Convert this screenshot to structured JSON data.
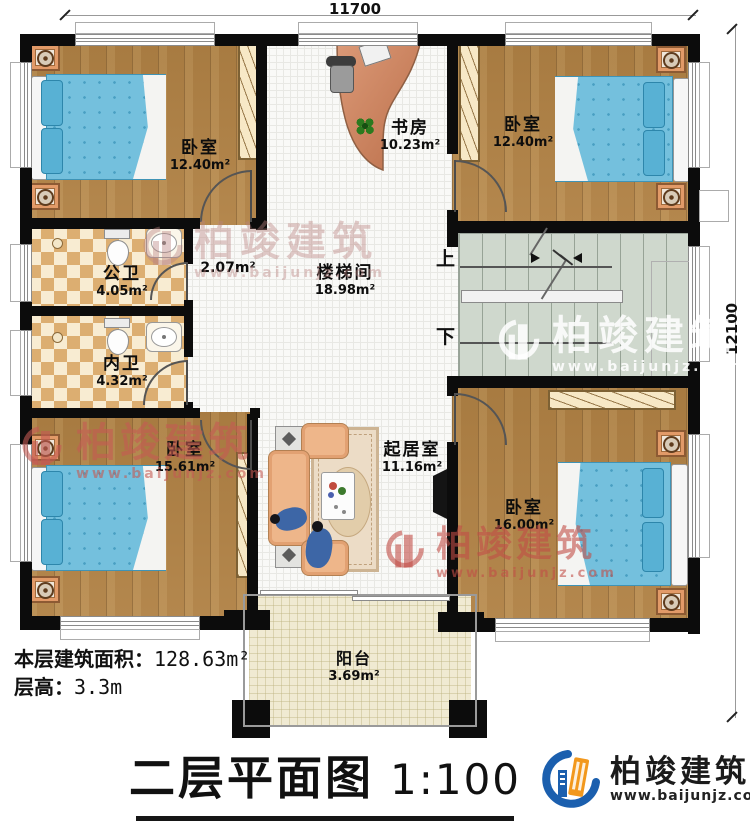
{
  "dimensions": {
    "width": "11700",
    "depth": "12100"
  },
  "rooms": [
    {
      "name": "卧室",
      "area": "12.40m²"
    },
    {
      "name": "书房",
      "area": "10.23m²"
    },
    {
      "name": "卧室",
      "area": "12.40m²"
    },
    {
      "name": "公卫",
      "area": "4.05m²"
    },
    {
      "name": "",
      "area": "2.07m²"
    },
    {
      "name": "楼梯间",
      "area": "18.98m²"
    },
    {
      "name": "内卫",
      "area": "4.32m²"
    },
    {
      "name": "卧室",
      "area": "15.61m²"
    },
    {
      "name": "起居室",
      "area": "11.16m²"
    },
    {
      "name": "卧室",
      "area": "16.00m²"
    },
    {
      "name": "阳台",
      "area": "3.69m²"
    }
  ],
  "stairs": {
    "up_label": "上",
    "down_label": "下"
  },
  "summary": {
    "floor_area_label": "本层建筑面积：",
    "floor_area_value": "128.63m²",
    "floor_height_label": "层高：",
    "floor_height_value": "3.3m"
  },
  "title": {
    "text": "二层平面图",
    "scale": "1:100"
  },
  "brand": {
    "name": "柏竣建筑",
    "website": "www.baijunjz.com"
  },
  "watermarks": {
    "name": "柏竣建筑",
    "website": "www.baijunjz.com"
  },
  "colors": {
    "wall": "#0c0c0c",
    "wood": "#b08144",
    "bed_blue": "#74c0dd",
    "brand_blue": "#1b5fae",
    "brand_orange": "#f2981d",
    "watermark_red": "#c75f58"
  }
}
